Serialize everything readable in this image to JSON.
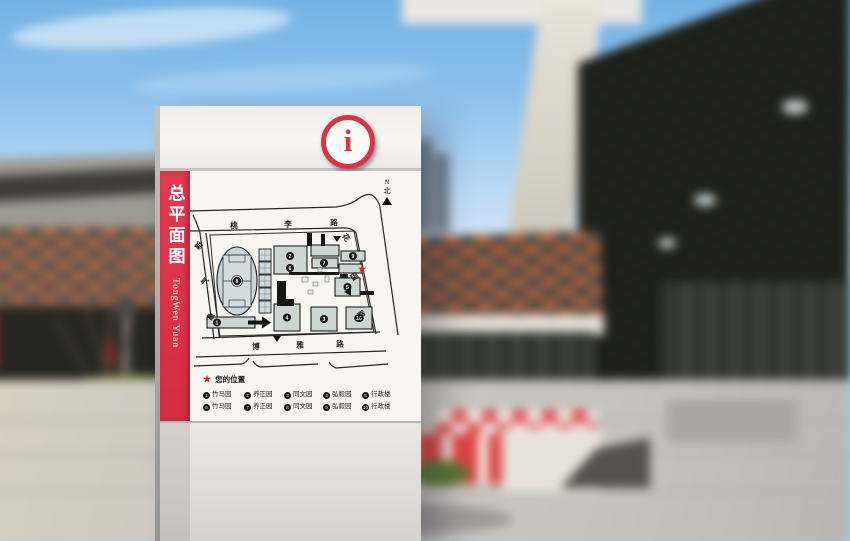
{
  "sign": {
    "side": {
      "title": "总平面图",
      "subtitle": "TongWen Yuan"
    },
    "header": {
      "info_glyph": "i"
    },
    "map": {
      "north": {
        "letter": "N",
        "char": "北"
      },
      "roads": {
        "top": [
          "桃",
          "李",
          "路"
        ],
        "bottom": [
          "博",
          "雅",
          "路"
        ],
        "left": [
          "新",
          "气",
          "象"
        ],
        "right": [
          "花",
          "园",
          "路"
        ]
      },
      "you_are_here_marker": "★",
      "building_numbers": {
        "stadium": "8",
        "track_side_building": "1",
        "northwest_upper": "2",
        "northwest_lower": "6",
        "north_middle": "7",
        "northeast": "9",
        "east_middle": "5",
        "southwest": "4",
        "south_middle": "3",
        "southeast": "10"
      }
    },
    "legend": {
      "star": "★",
      "title": "您的位置",
      "rows": [
        [
          {
            "num": "1",
            "label": "竹马园"
          },
          {
            "num": "2",
            "label": "养正园"
          },
          {
            "num": "3",
            "label": "同文园"
          },
          {
            "num": "4",
            "label": "弘毅园"
          },
          {
            "num": "5",
            "label": "行政楼"
          }
        ],
        [
          {
            "num": "6",
            "label": "竹马园"
          },
          {
            "num": "7",
            "label": "养正园"
          },
          {
            "num": "8",
            "label": "同文园"
          },
          {
            "num": "9",
            "label": "弘毅园"
          },
          {
            "num": "10",
            "label": "行政楼"
          }
        ]
      ]
    }
  },
  "colors": {
    "sign_red": "#dc3447",
    "map_ink": "#262626",
    "building_fill": "#ccd5d1",
    "star_red": "#d8232f"
  }
}
